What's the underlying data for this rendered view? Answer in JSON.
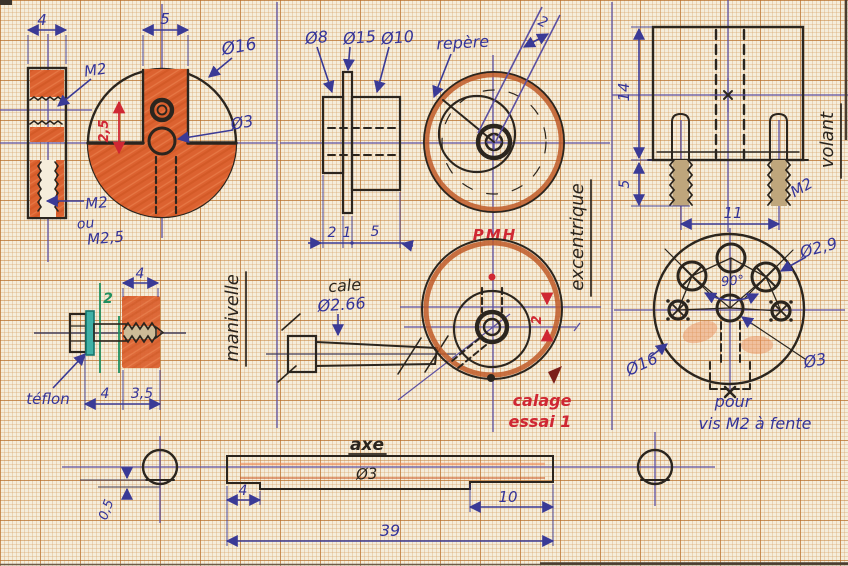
{
  "colors": {
    "paper": "#f5eddb",
    "grid_major": "#b46a28",
    "grid_minor": "#d8a468",
    "pencil_orange": "#dc6230",
    "ink_blue": "#34349a",
    "ink_purple": "#5b50a2",
    "ink_black": "#2b251e",
    "ink_red": "#cf2733",
    "ink_green": "#1f8f5f",
    "teflon_teal": "#3fb0a6"
  },
  "manivelle": {
    "name_label": "manivelle",
    "dim_width": "4",
    "dim_slot": "5",
    "outer_dia": "Ø16",
    "hole_dia": "Ø3",
    "thread_label": "M2",
    "offset_dim_red": "2,5",
    "thread_note_line1": "M2",
    "thread_note_line2": "ou",
    "thread_note_line3": "M2,5"
  },
  "teflon_screw": {
    "teflon_label": "téflon",
    "dim_top": "4",
    "dim_green": "2",
    "dim_head": "4",
    "dim_body": "3,5"
  },
  "excentrique": {
    "name_label": "excentrique",
    "dia_small": "Ø8",
    "dia_flange": "Ø15",
    "dia_body": "Ø10",
    "dim_a": "2",
    "dim_b": "1",
    "dim_c": "5",
    "repere_label": "repère",
    "offset_dim": "2",
    "pmh_label": "PMH",
    "cale_label": "cale",
    "cale_dia": "Ø2.66",
    "calage_offset": "2",
    "calage_line1": "calage",
    "calage_line2": "essai 1"
  },
  "volant": {
    "name_label": "volant",
    "dim_height": "14",
    "dim_screw": "5",
    "dim_spacing": "11",
    "thread_label": "M2",
    "hole_dia": "Ø2,9",
    "angle": "90°",
    "outer_dia": "Ø16",
    "axle_dia": "Ø3",
    "note_line1": "pour",
    "note_line2": "vis M2 à fente"
  },
  "axe": {
    "name_label": "axe",
    "dia": "Ø3",
    "dim_flat_left": "4",
    "dim_flat_right": "10",
    "dim_length": "39",
    "dim_flat_depth": "0,5"
  }
}
